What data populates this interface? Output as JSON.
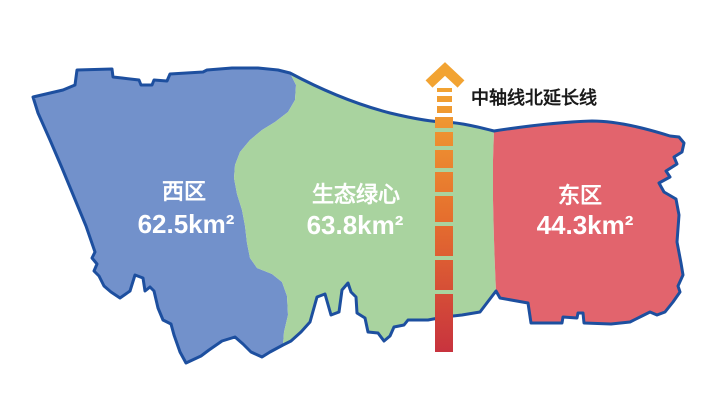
{
  "regions": {
    "west": {
      "name": "西区",
      "area": "62.5km²",
      "color": "#7291CB"
    },
    "center": {
      "name": "生态绿心",
      "area": "63.8km²",
      "color": "#A9D39F"
    },
    "east": {
      "name": "东区",
      "area": "44.3km²",
      "color": "#E2646D"
    }
  },
  "axis": {
    "label": "中轴线北延长线",
    "label_color": "#1A1A1A",
    "arrow_color": "#F2A332",
    "gradient_top": "#F2A332",
    "gradient_mid": "#E56E2E",
    "gradient_bottom": "#C8333E"
  },
  "map": {
    "outline_color": "#1D4F9F",
    "background_color": "#FFFFFF",
    "label_color": "#FFFFFF"
  }
}
